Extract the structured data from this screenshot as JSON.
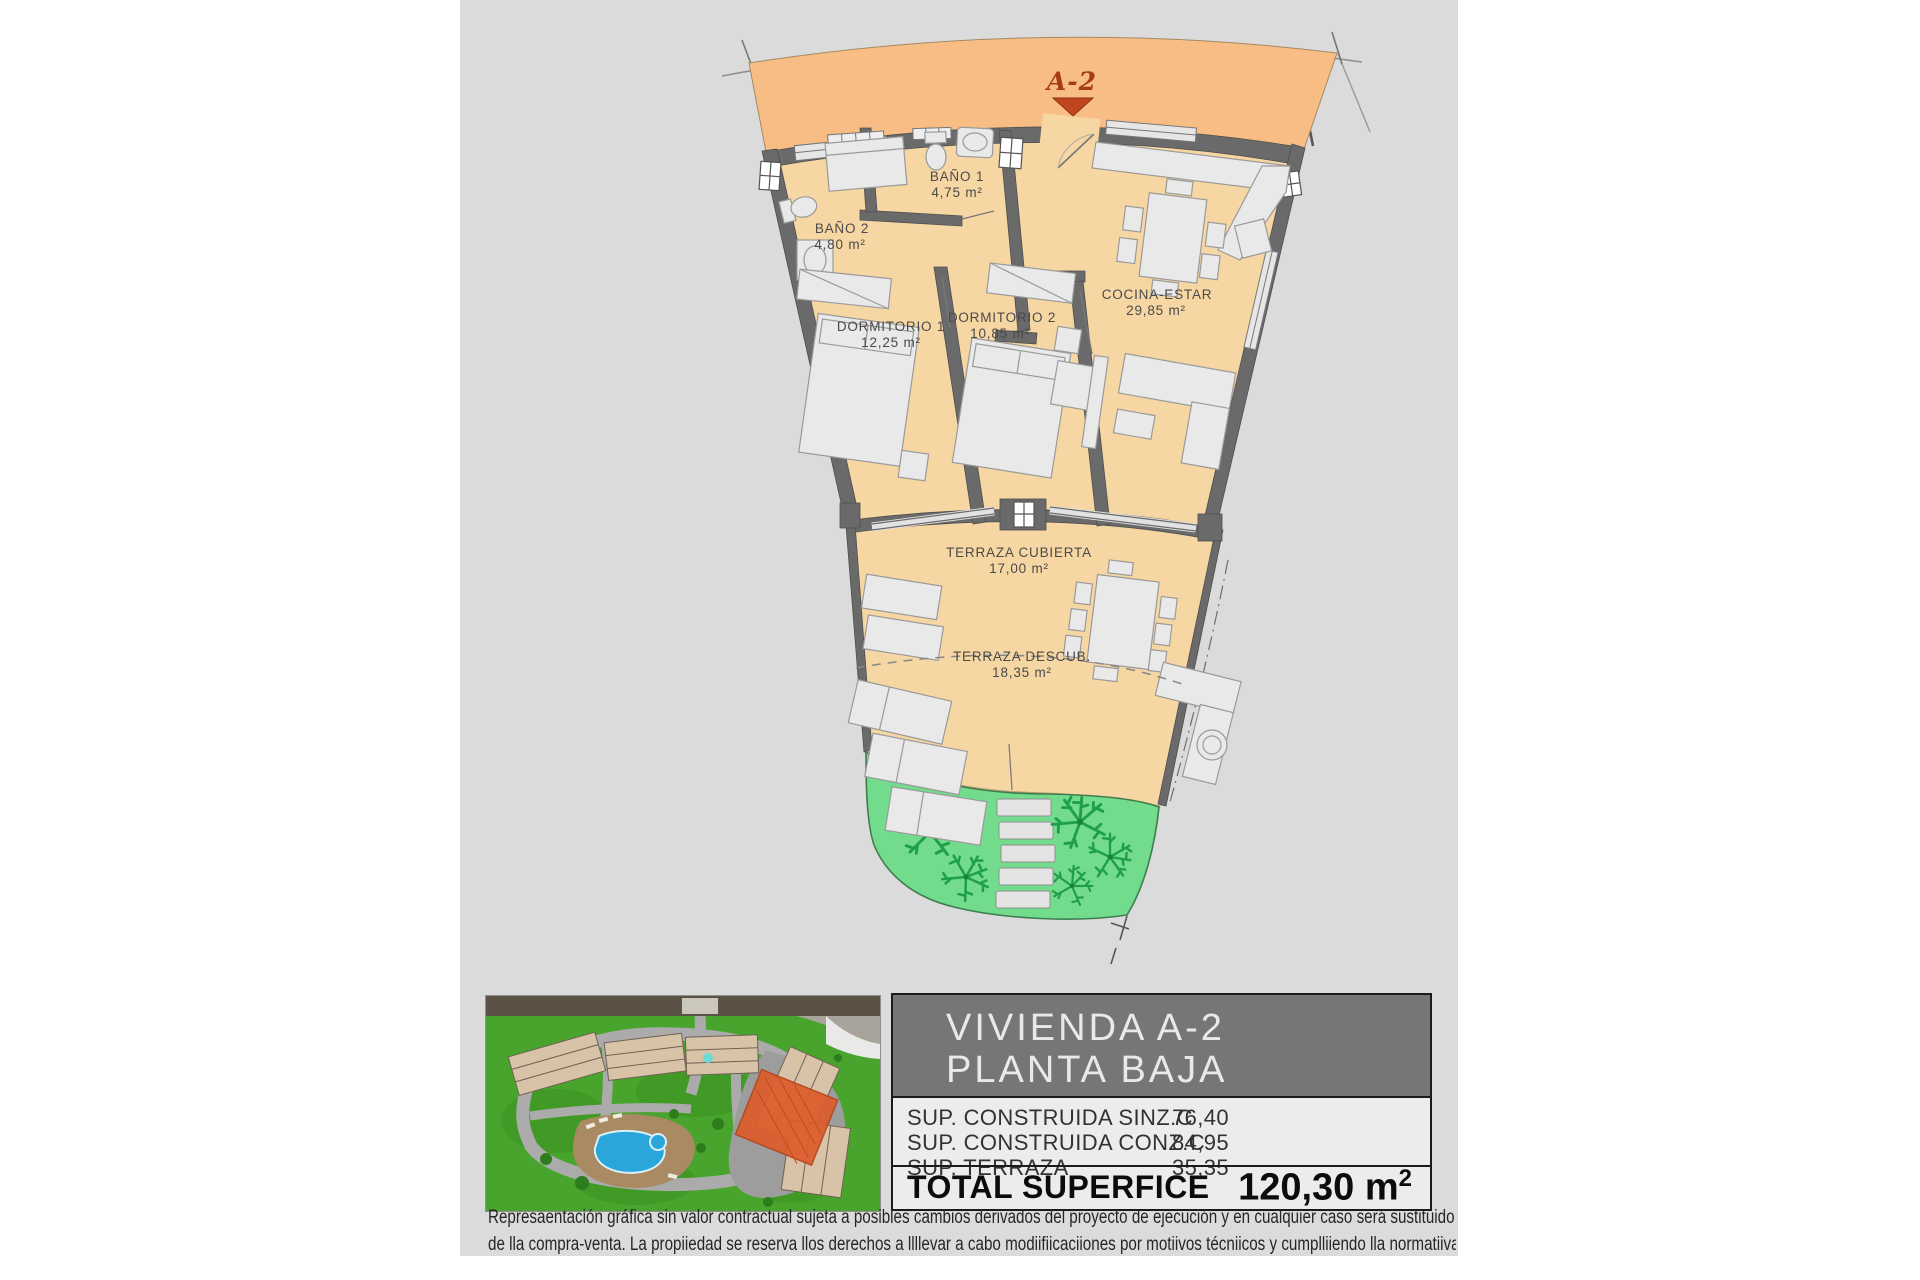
{
  "plan": {
    "unit_marker": {
      "label": "A-2"
    },
    "rooms": [
      {
        "name": "BAÑO 1",
        "area": "4,75 m²"
      },
      {
        "name": "BAÑO 2",
        "area": "4,80 m²"
      },
      {
        "name": "DORMITORIO 1",
        "area": "12,25 m²"
      },
      {
        "name": "DORMITORIO 2",
        "area": "10,85 m²"
      },
      {
        "name": "COCINA-ESTAR",
        "area": "29,85 m²"
      },
      {
        "name": "TERRAZA CUBIERTA",
        "area": "17,00 m²"
      },
      {
        "name": "TERRAZA DESCUB.",
        "area": "18,35 m²"
      }
    ]
  },
  "info_panel": {
    "title_line1": "VIVIENDA A-2",
    "title_line2": "PLANTA BAJA",
    "rows": [
      {
        "label": "SUP. CONSTRUIDA SINZ.C",
        "value": "76,40"
      },
      {
        "label": "SUP. CONSTRUIDA CONZ.C",
        "value": "84,95"
      },
      {
        "label": "SUP. TERRAZA",
        "value": "35,35"
      }
    ],
    "total_label": "TOTAL SUPERFICE",
    "total_value": "120,30 m",
    "total_sup": "2"
  },
  "disclaimer": {
    "line1": "Represaentación gráfica sin valor contractual sujeta a posibles cambios derivados del proyecto de ejecución y en cualquier caso será sustituido por el definitivo en",
    "line2": "de lla compra-venta. La propiiedad se reserva llos derechos a llllevar a cabo modiifiicaciiones por motiivos técniicos y cumplliiendo lla normatiiva viigente."
  },
  "colors": {
    "canvas_gray": "#dbdbdb",
    "corridor_orange": "#f7bd85",
    "floor_tan": "#f6d6a2",
    "wall_gray": "#6a6a6a",
    "garden_green": "#72dc8c",
    "marker_red": "#c2461d",
    "header_gray": "#767676",
    "panel_light": "#ececec"
  }
}
